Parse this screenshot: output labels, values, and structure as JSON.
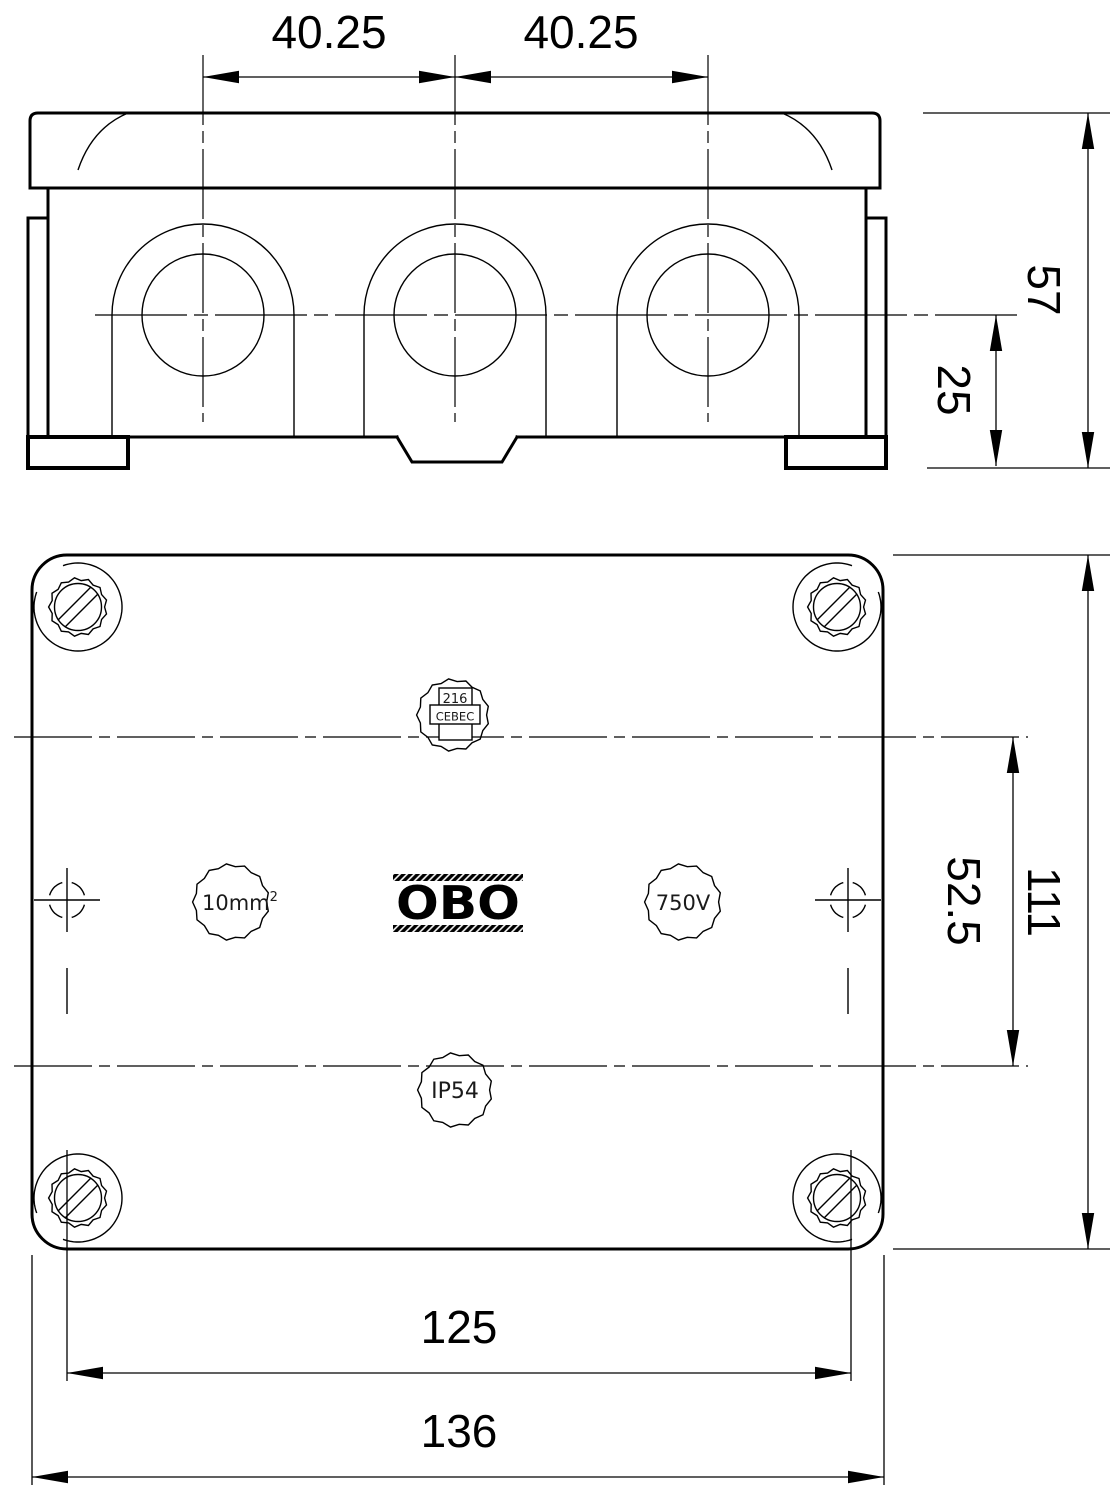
{
  "drawing": {
    "type": "technical-drawing",
    "subject": "junction-box",
    "colors": {
      "background": "#ffffff",
      "line": "#000000"
    }
  },
  "dimensions": {
    "knockout_spacing_left": "40.25",
    "knockout_spacing_right": "40.25",
    "total_height": "57",
    "knockout_center_height": "25",
    "hole_row_spacing": "52.5",
    "box_height": "111",
    "lid_width": "125",
    "box_width": "136"
  },
  "markings": {
    "cert_code": "216",
    "cert_label": "CEBEC",
    "conductor_size": "10mm",
    "conductor_size_exponent": "2",
    "voltage_rating": "750V",
    "brand": "OBO",
    "ip_rating": "IP54"
  }
}
